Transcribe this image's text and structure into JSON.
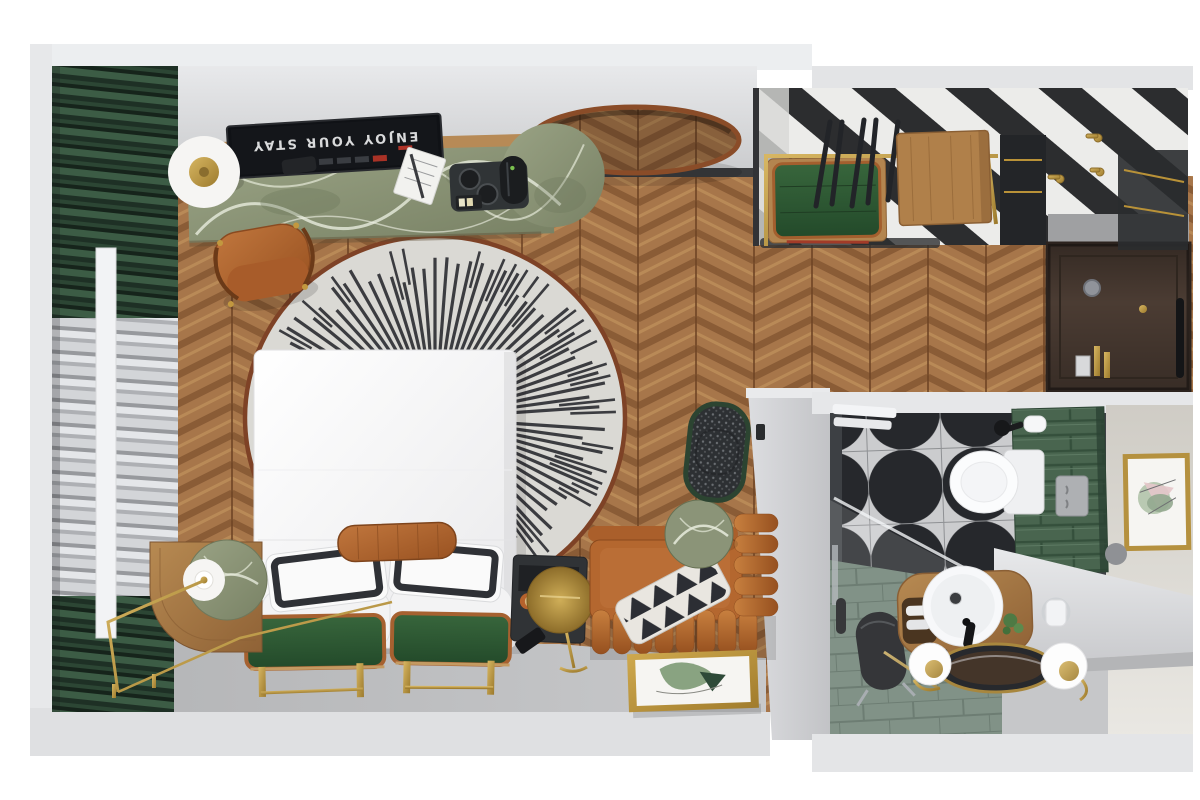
{
  "scene": {
    "title": "Hotel guest room - top-down 3D floor plan render",
    "view": "top-down axonometric",
    "tv": {
      "screen_text": "ENJOY YOUR STAY"
    },
    "palette": {
      "wood": "#a7764a",
      "wood_dark": "#8a5c36",
      "wood_light": "#b98a57",
      "stripe_dark": "#2c2d2f",
      "stripe_light": "#ececea",
      "curtain_green": "#2c4634",
      "sheer_gray": "#c3c6c9",
      "rug_base": "#dad9d4",
      "rug_border": "#7e4226",
      "rug_line": "#3b3c40",
      "marble_green": "#8b9478",
      "leather": "#b4672f",
      "bench_green": "#2d5836",
      "brass": "#c29a3e",
      "concrete": "#b7b8ba",
      "wall_gray": "#dcdddf",
      "door_brown": "#4b3c33",
      "tile_dark": "#26282c",
      "tile_light": "#cbccce",
      "subway_green": "#49654f",
      "shower_floor": "#6d8174",
      "linen_white": "#fbfbfb",
      "tv_text": "#d9dadb"
    },
    "bedroom": {
      "floor": "chevron oak parquet",
      "rug": "round sunburst rug, charcoal dashes on ivory, rust border",
      "items": [
        "wall TV with welcome screen",
        "green marble desk with round end",
        "white disc desk lamp",
        "remote control",
        "notepad with pen",
        "coffee tray with kettle and cups",
        "cognac leather desk chair",
        "round copper wall mirror",
        "double bed with white duvet",
        "two black-trim pillows",
        "two white pillows",
        "leather bolster",
        "two green leather benches with brass legs",
        "curved oak nightstand with green marble top",
        "globe table lamp",
        "brass wire floor lamp",
        "black side shelf with snack tray",
        "brass disc side table",
        "cognac channel-tufted leather sofa",
        "black-white triangle cushion",
        "green marble side table",
        "charcoal tweed armchair with green piping",
        "leaning botanical artwork in gold frame"
      ]
    },
    "wardrobe": {
      "floor": "black and white diagonal striped runner",
      "items": [
        "brass clothes rail",
        "black hangers",
        "green leather luggage bench with red strap",
        "oak drawer cabinet",
        "dark shelving unit",
        "brass wall hooks"
      ]
    },
    "entry": {
      "items": [
        "dark brown entrance door",
        "peephole",
        "brass keyhole",
        "door closer",
        "key card",
        "minibar bottles"
      ]
    },
    "bathroom": {
      "floor": "black quarter-circle fan tiles and sage shower planks",
      "items": [
        "wall-hung toilet",
        "green subway tile wall",
        "flush plate",
        "toilet paper holder",
        "white towels",
        "glass shower screen",
        "black shower stool",
        "hand shower",
        "oak vanity with open shelf",
        "round white basin",
        "black faucet",
        "potted plant",
        "oval brass-framed mirror",
        "two white globe sconces",
        "chrome towel ring with towel",
        "gold-framed abstract artwork",
        "grey wall dot"
      ]
    }
  }
}
